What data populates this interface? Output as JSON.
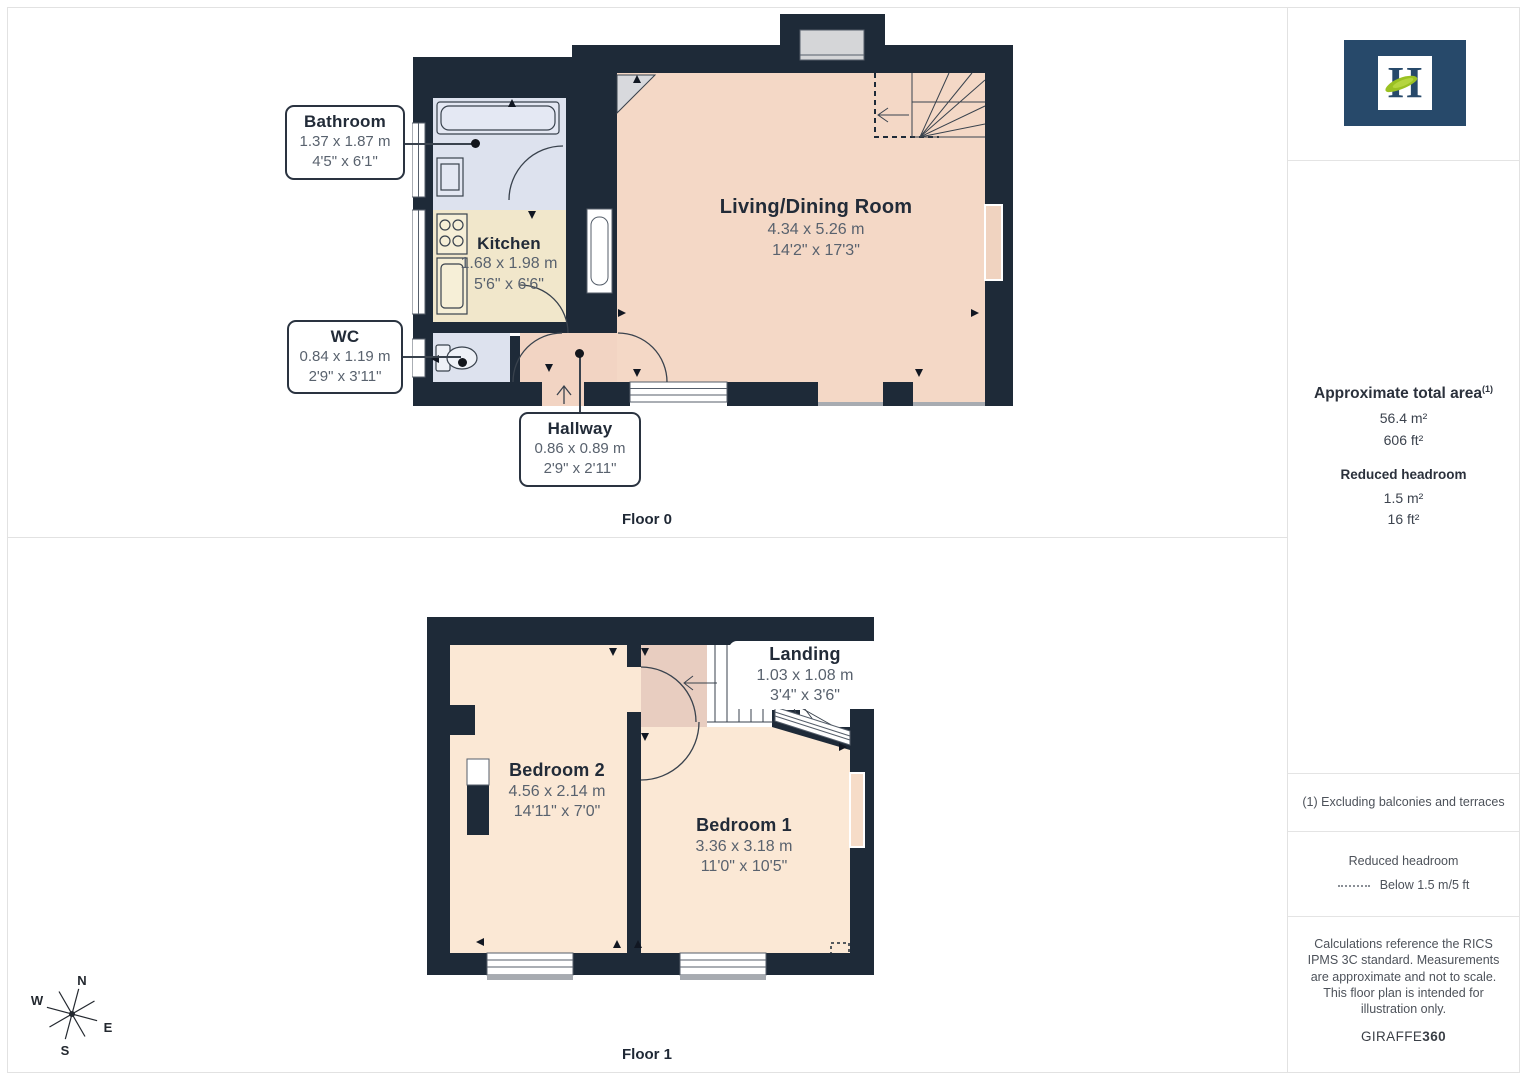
{
  "floor0": {
    "caption": "Floor 0",
    "rooms": {
      "bathroom": {
        "name": "Bathroom",
        "metric": "1.37 x 1.87 m",
        "imperial": "4'5\" x 6'1\""
      },
      "kitchen": {
        "name": "Kitchen",
        "metric": "1.68 x 1.98 m",
        "imperial": "5'6\" x 6'6\""
      },
      "wc": {
        "name": "WC",
        "metric": "0.84 x 1.19 m",
        "imperial": "2'9\" x 3'11\""
      },
      "hallway": {
        "name": "Hallway",
        "metric": "0.86 x 0.89 m",
        "imperial": "2'9\" x 2'11\""
      },
      "living": {
        "name": "Living/Dining Room",
        "metric": "4.34 x 5.26 m",
        "imperial": "14'2\" x 17'3\""
      }
    }
  },
  "floor1": {
    "caption": "Floor 1",
    "rooms": {
      "bedroom2": {
        "name": "Bedroom 2",
        "metric": "4.56 x 2.14 m",
        "imperial": "14'11\" x 7'0\""
      },
      "bedroom1": {
        "name": "Bedroom 1",
        "metric": "3.36 x 3.18 m",
        "imperial": "11'0\" x 10'5\""
      },
      "landing": {
        "name": "Landing",
        "metric": "1.03 x 1.08 m",
        "imperial": "3'4\" x 3'6\""
      }
    }
  },
  "compass": {
    "n": "N",
    "e": "E",
    "s": "S",
    "w": "W"
  },
  "sidebar": {
    "logo_letter": "H",
    "area": {
      "title": "Approximate total area",
      "superscript": "(1)",
      "m2": "56.4 m²",
      "ft2": "606 ft²"
    },
    "headroom": {
      "title": "Reduced headroom",
      "m2": "1.5 m²",
      "ft2": "16 ft²"
    },
    "footnote": "(1) Excluding balconies and terraces",
    "legend": {
      "title": "Reduced headroom",
      "label": "Below 1.5 m/5 ft"
    },
    "disclaimer": "Calculations reference the RICS IPMS 3C standard. Measurements are approximate and not to scale. This floor plan is intended for illustration only.",
    "brand": {
      "name": "GIRAFFE",
      "bold": "360"
    }
  },
  "colors": {
    "wall": "#1e2a38",
    "living": "#f4d8c6",
    "bedroom": "#fbe8d5",
    "kitchen": "#f1e7cb",
    "bathroom": "#dde2ee",
    "hallway": "#f2d4c3",
    "landing": "#e8cdc0",
    "logo_navy": "#27496a",
    "logo_green": "#9bc122"
  }
}
